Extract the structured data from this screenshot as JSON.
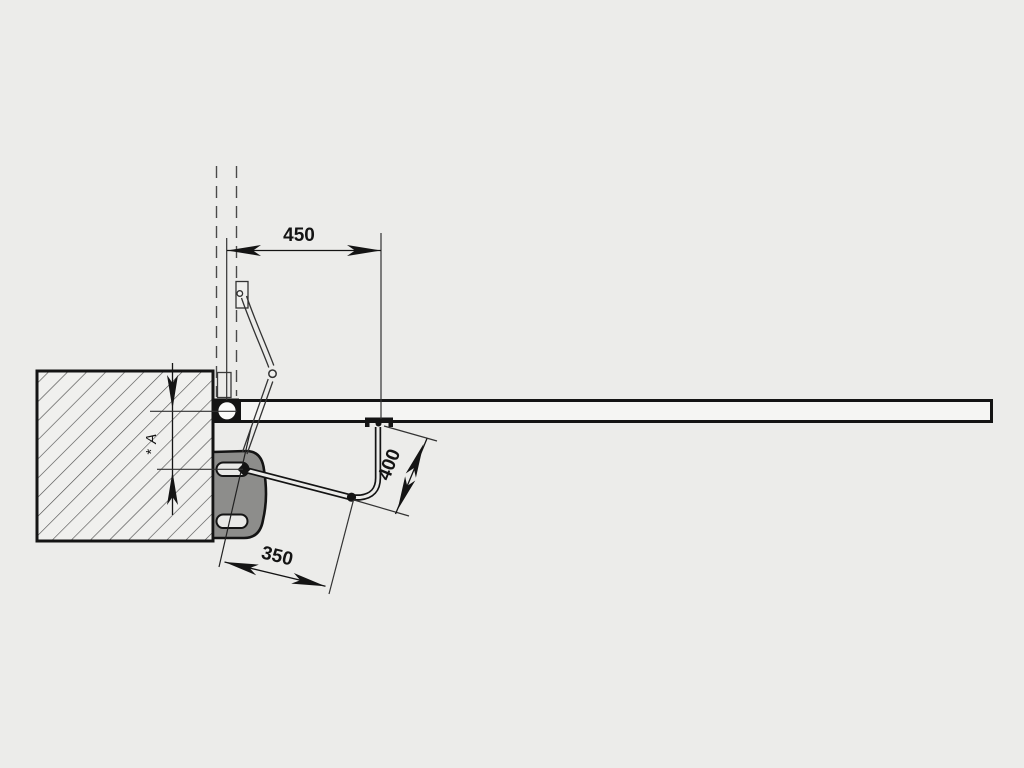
{
  "diagram": {
    "dimension_labels": {
      "top_width": "450",
      "arm_length": "400",
      "bottom_width": "350",
      "pillar_offset": "* A"
    },
    "colors": {
      "background": "#ececea",
      "stroke_heavy": "#141414",
      "stroke_thin": "#333333",
      "wall_fill": "#f0f0ee",
      "gate_fill": "#f5f5f3",
      "motor_fill": "#8d8d8b",
      "slot_fill": "#e9e9e7"
    }
  }
}
